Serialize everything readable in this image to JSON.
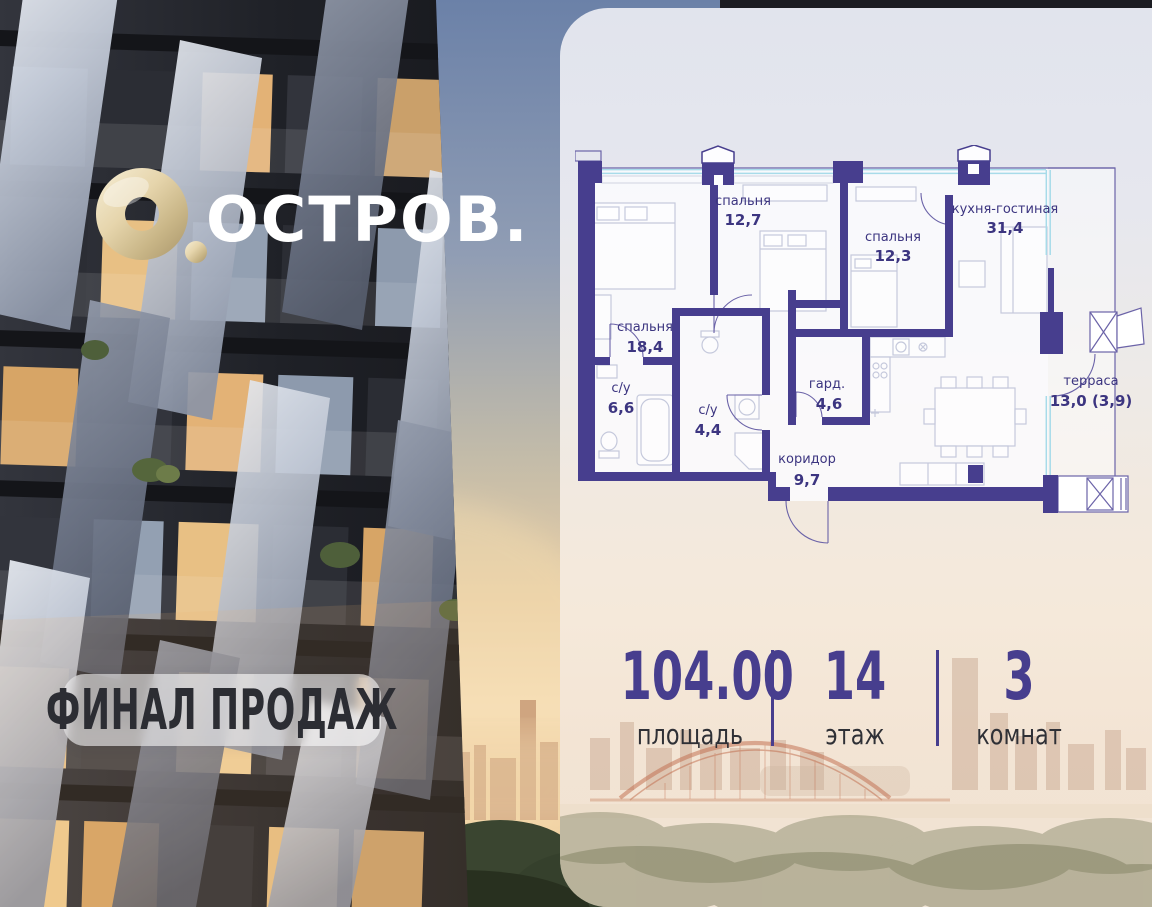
{
  "brand": {
    "name": "ОСТРОВ.",
    "mark": "torus-icon"
  },
  "photo_badge": {
    "label": "ФИНАЛ ПРОДАЖ"
  },
  "floor_plan": {
    "rooms": [
      {
        "name": "спальня",
        "area": "12,7"
      },
      {
        "name": "спальня",
        "area": "12,3"
      },
      {
        "name": "кухня-гостиная",
        "area": "31,4"
      },
      {
        "name": "спальня",
        "area": "18,4"
      },
      {
        "name": "с/у",
        "area": "6,6"
      },
      {
        "name": "с/у",
        "area": "4,4"
      },
      {
        "name": "гард.",
        "area": "4,6"
      },
      {
        "name": "коридор",
        "area": "9,7"
      },
      {
        "name": "терраса",
        "area": "13,0 (3,9)"
      }
    ]
  },
  "stats": {
    "area": {
      "value": "104.00",
      "label": "площадь"
    },
    "floor": {
      "value": "14",
      "label": "этаж"
    },
    "rooms": {
      "value": "3",
      "label": "комнат"
    }
  },
  "colors": {
    "wall": "#473e8e",
    "accent": "#473e8e",
    "window": "#a7dbe9",
    "gold": "#d9c69b"
  }
}
